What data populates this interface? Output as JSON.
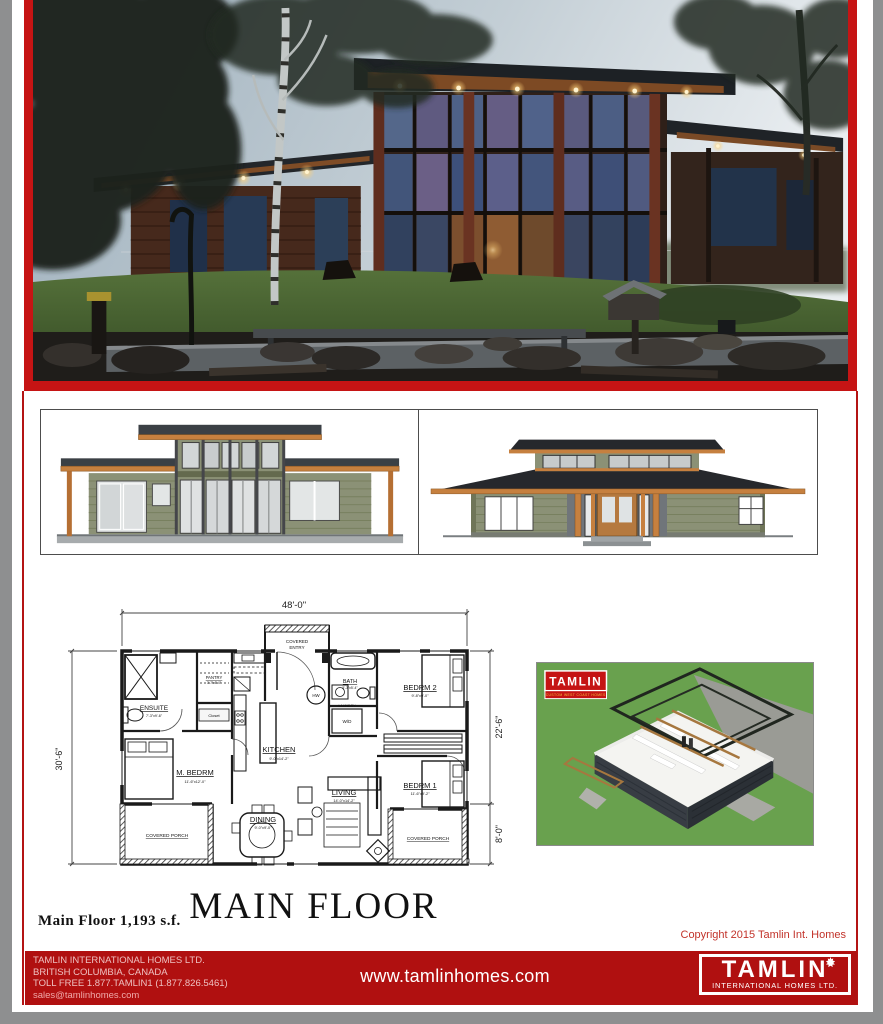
{
  "page": {
    "copyright": "Copyright 2015 Tamlin Int. Homes"
  },
  "footer": {
    "company": "TAMLIN INTERNATIONAL HOMES LTD.",
    "location": "BRITISH COLUMBIA, CANADA",
    "phone": "TOLL FREE 1.877.TAMLIN1 (1.877.826.5461)",
    "email": "sales@tamlinhomes.com",
    "website": "www.tamlinhomes.com",
    "logo_text": "TAMLIN",
    "logo_subtext": "INTERNATIONAL HOMES LTD."
  },
  "render3d": {
    "logo_text": "TAMLIN",
    "logo_tagline": "CUSTOM WEST COAST HOMES"
  },
  "floor_plan": {
    "title": "MAIN FLOOR",
    "area": "Main Floor 1,193 s.f.",
    "dims": {
      "overall_width": "48'-0\"",
      "overall_depth": "30'-6\"",
      "house_depth": "22'-6\"",
      "porch_depth": "8'-0\""
    },
    "rooms": [
      {
        "label": "ENSUITE",
        "size": "7'-3\"x9'-6\""
      },
      {
        "label": "PANTRY",
        "size": "3'-7\"x5'-0\""
      },
      {
        "label": "M. BEDRM",
        "size": "11'-6\"x12'-0\""
      },
      {
        "label": "KITCHEN",
        "size": "9'-0\"x14'-2\""
      },
      {
        "label": "BATH",
        "size": "5'-3\"x5'-4\""
      },
      {
        "label": "BEDRM 2",
        "size": "9'-8\"x9'-0\""
      },
      {
        "label": "BEDRM 1",
        "size": "11'-6\"x9'-2\""
      },
      {
        "label": "DINING",
        "size": "9'-0\"x9'-0\""
      },
      {
        "label": "LIVING",
        "size": "14'-0\"x14'-2\""
      }
    ],
    "annotations": {
      "covered_entry_line1": "COVERED",
      "covered_entry_line2": "ENTRY",
      "covered_porch": "COVERED PORCH",
      "closet": "Closet",
      "laundry": "LAUNDRY",
      "washer_dryer": "W/D",
      "hot_water": "HW"
    }
  }
}
